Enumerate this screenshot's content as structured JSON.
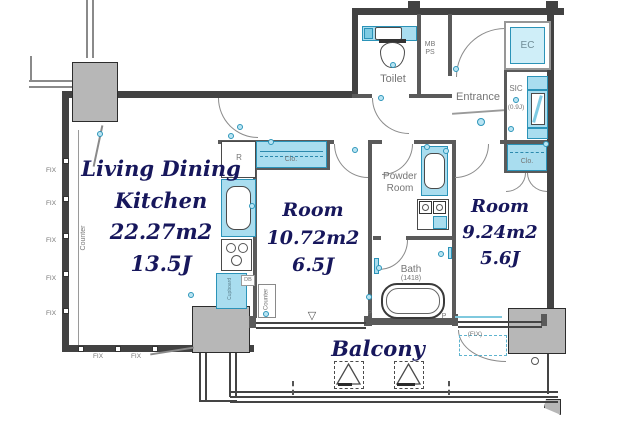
{
  "meta": {
    "type": "apartment-floor-plan"
  },
  "colors": {
    "wall": "#424242",
    "pillar": "#b7b7b7",
    "fixture_fill": "#a9ddef",
    "fixture_border": "#2b93b8",
    "ec_fill": "#cfeef8",
    "room_text": "#17175c",
    "label_text": "#757575",
    "background": "#ffffff"
  },
  "rooms": {
    "ldk": {
      "name": "Living Dining Kitchen",
      "area": "22.27m2",
      "size": "13.5J"
    },
    "room1": {
      "name": "Room",
      "area": "10.72m2",
      "size": "6.5J"
    },
    "room2": {
      "name": "Room",
      "area": "9.24m2",
      "size": "5.6J"
    },
    "balcony": {
      "name": "Balcony"
    },
    "toilet": {
      "name": "Toilet"
    },
    "entrance": {
      "name": "Entrance"
    },
    "powder_room": {
      "line1": "Powder",
      "line2": "Room"
    },
    "bath": {
      "name": "Bath",
      "size": "(1418)"
    },
    "ec": {
      "name": "EC"
    },
    "sic": {
      "name": "SIC",
      "size": "(0.9J)"
    },
    "mb_ps": {
      "line1": "MB",
      "line2": "PS"
    }
  },
  "labels": {
    "closet": "Clo.",
    "fix": "FIX",
    "fix_paren": "(FIX)",
    "counter": "Counter",
    "refrigerator": "R",
    "pipe": "P",
    "db": "DB",
    "cupboard": "Cupboard",
    "down_triangle": "▽"
  },
  "symbols": {
    "evacuation_hatch": "dashed square with triangle",
    "door_swing": "quarter-circle arc",
    "fixture_dot": "small cyan circle",
    "window_node": "small white square on wall"
  }
}
